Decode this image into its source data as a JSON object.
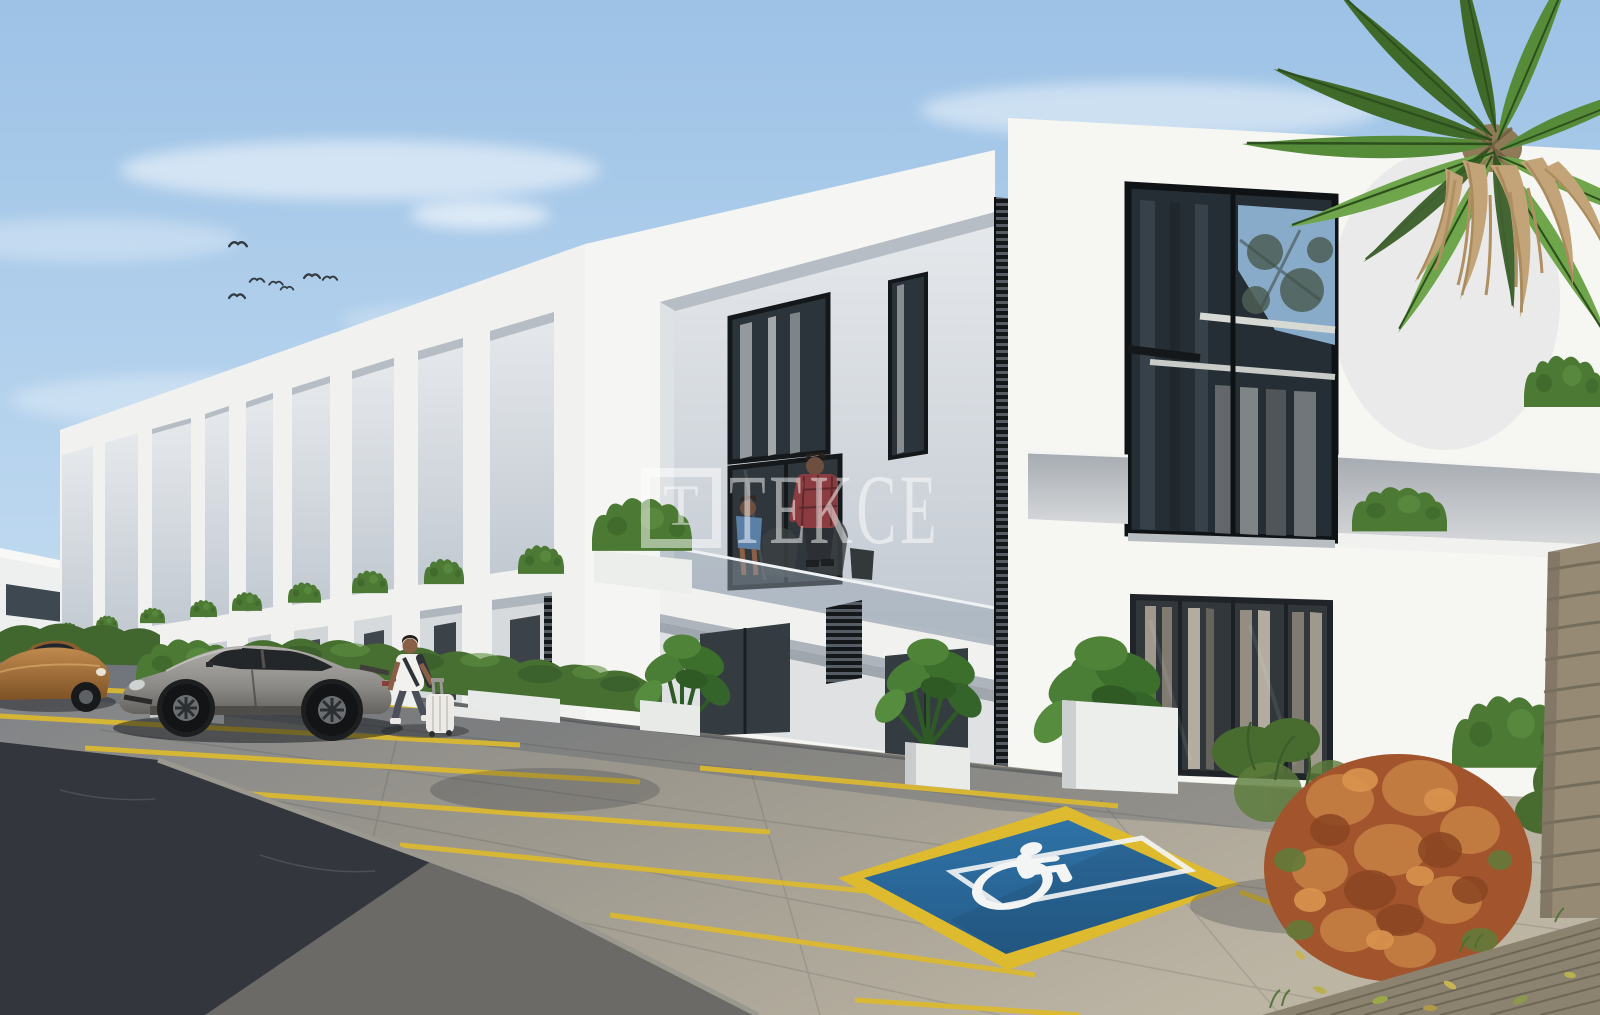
{
  "watermark": {
    "logo_letter": "T",
    "brand_text": "TEKCE"
  },
  "scene": {
    "type": "3d-architectural-render",
    "subject": "Modern white two-storey townhouse complex with front parking lot",
    "elements": [
      "row of white townhouses with recessed balconies",
      "hedge planters on balcony ledges",
      "couple on balcony",
      "man walking with suitcase",
      "grey sports car",
      "bronze sedan",
      "children playground",
      "disabled parking space with wheelchair marking",
      "yellow parking lines",
      "palm tree",
      "orange shrub",
      "wooden deck with fallen leaves"
    ],
    "colors": {
      "sky_top": "#a3c7e9",
      "sky_horizon": "#d9e9f6",
      "facade_white": "#f5f5f3",
      "recess_gray": "#c9cfd6",
      "glass_dark": "#2c343b",
      "hedge_green": "#4c7a35",
      "disabled_space_blue": "#2e6fa3",
      "parking_line_yellow": "#ddba2e",
      "asphalt_dark": "#33363c",
      "paver_beige": "#b9b2a2",
      "bush_orange": "#a2552c",
      "palm_green": "#4e7b35",
      "sports_car_gray": "#8b8a86",
      "sedan_bronze": "#a06c3a",
      "watermark_white": "#ffffff"
    }
  }
}
